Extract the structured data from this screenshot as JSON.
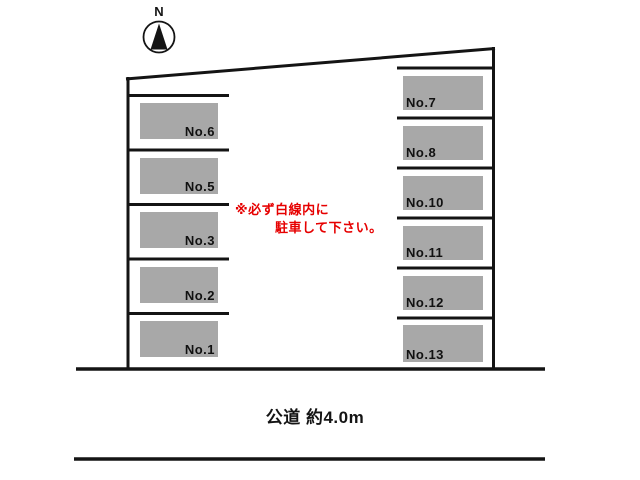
{
  "compass": {
    "label": "N"
  },
  "spaces": {
    "left": [
      {
        "label": "No.6"
      },
      {
        "label": "No.5"
      },
      {
        "label": "No.3"
      },
      {
        "label": "No.2"
      },
      {
        "label": "No.1"
      }
    ],
    "right": [
      {
        "label": "No.7"
      },
      {
        "label": "No.8"
      },
      {
        "label": "No.10"
      },
      {
        "label": "No.11"
      },
      {
        "label": "No.12"
      },
      {
        "label": "No.13"
      }
    ]
  },
  "notice": {
    "line1": "※必ず白線内に",
    "line2": "駐車して下さい。",
    "color": "#e60000"
  },
  "road": {
    "label": "公道 約4.0m"
  },
  "colors": {
    "boundary_line": "#141414",
    "space_fill": "#a8a8a8",
    "notice_red": "#e60000"
  }
}
